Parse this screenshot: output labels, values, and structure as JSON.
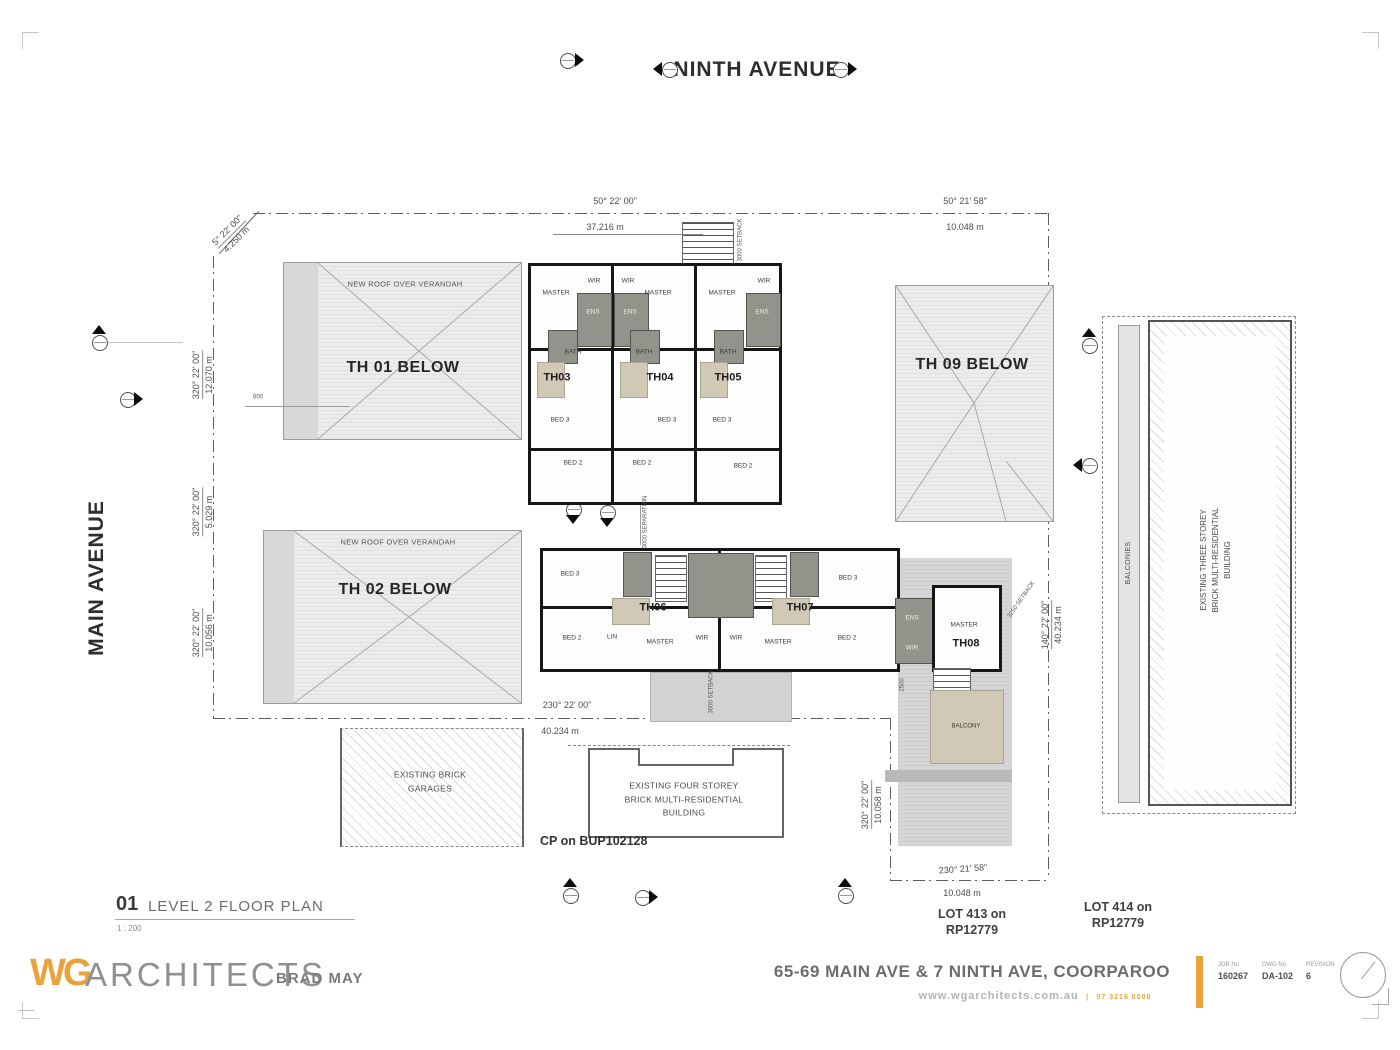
{
  "streets": {
    "top": "NINTH AVENUE",
    "left": "MAIN AVENUE"
  },
  "units": {
    "th01": "TH 01 BELOW",
    "th02": "TH 02 BELOW",
    "th09": "TH 09 BELOW",
    "th03": "TH03",
    "th04": "TH04",
    "th05": "TH05",
    "th06": "TH06",
    "th07": "TH07",
    "th08": "TH08"
  },
  "rooms": {
    "master": "MASTER",
    "wir": "WIR",
    "ens": "ENS",
    "bath": "BATH",
    "bed2": "BED 2",
    "bed3": "BED 3",
    "lin": "LIN",
    "balcony": "BALCONY"
  },
  "annotations": {
    "new_roof": "NEW ROOF OVER VERANDAH",
    "garages_1": "EXISTING BRICK",
    "garages_2": "GARAGES",
    "four_storey_1": "EXISTING FOUR STOREY",
    "four_storey_2": "BRICK MULTI-RESIDENTIAL",
    "four_storey_3": "BUILDING",
    "three_storey_1": "EXISTING THREE STOREY",
    "three_storey_2": "BRICK MULTI-RESIDENTIAL",
    "three_storey_3": "BUILDING",
    "balconies": "BALCONIES",
    "cp": "CP on BUP102128",
    "lot413_1": "LOT 413 on",
    "lot413_2": "RP12779",
    "lot414_1": "LOT 414 on",
    "lot414_2": "RP12779",
    "setback_top": "3000 SETBACK",
    "separation": "3000 SEPARATION",
    "setback_bottom": "3000 SETBACK",
    "setback_th08": "3250 SETBACK",
    "dim_600": "600",
    "dim_2500": "2500"
  },
  "dimensions": {
    "splay": {
      "angle": "5° 22' 00\"",
      "length": "4.250 m"
    },
    "top": {
      "angle": "50° 22' 00\"",
      "length": "37.216 m"
    },
    "top_right": {
      "angle": "50° 21' 58\"",
      "length": "10.048 m"
    },
    "left1": {
      "angle": "320° 22' 00\"",
      "length": "12.070 m"
    },
    "left2": {
      "angle": "320° 22' 00\"",
      "length": "5.029 m"
    },
    "left3": {
      "angle": "320° 22' 00\"",
      "length": "10.056 m"
    },
    "bottom": {
      "angle": "230° 22' 00\"",
      "length": "40.234 m"
    },
    "right": {
      "angle": "140° 22' 00\"",
      "length": "40.234 m"
    },
    "br_vert": {
      "angle": "320° 22' 00\"",
      "length": "10.058 m"
    },
    "br_horiz": {
      "angle": "230° 21' 58\"",
      "length": "10.048 m"
    }
  },
  "footer": {
    "drawing_number": "01",
    "drawing_title": "LEVEL 2 FLOOR PLAN",
    "scale": "1 : 200",
    "brand_mark": "WG",
    "brand_name": "ARCHITECTS",
    "architect": "BRAD MAY",
    "project_address": "65-69 MAIN AVE & 7 NINTH AVE, COORPAROO",
    "website": "www.wgarchitects.com.au",
    "phone": "07 3216 0000",
    "job_label": "JOB No",
    "job_value": "160267",
    "dwg_label": "DWG No",
    "dwg_value": "DA-102",
    "rev_label": "REVISION",
    "rev_value": "6"
  },
  "colors": {
    "accent": "#E8A33D",
    "wet_area": "#93938B",
    "landing": "#CFC9B6",
    "line": "#5E5E5E"
  }
}
